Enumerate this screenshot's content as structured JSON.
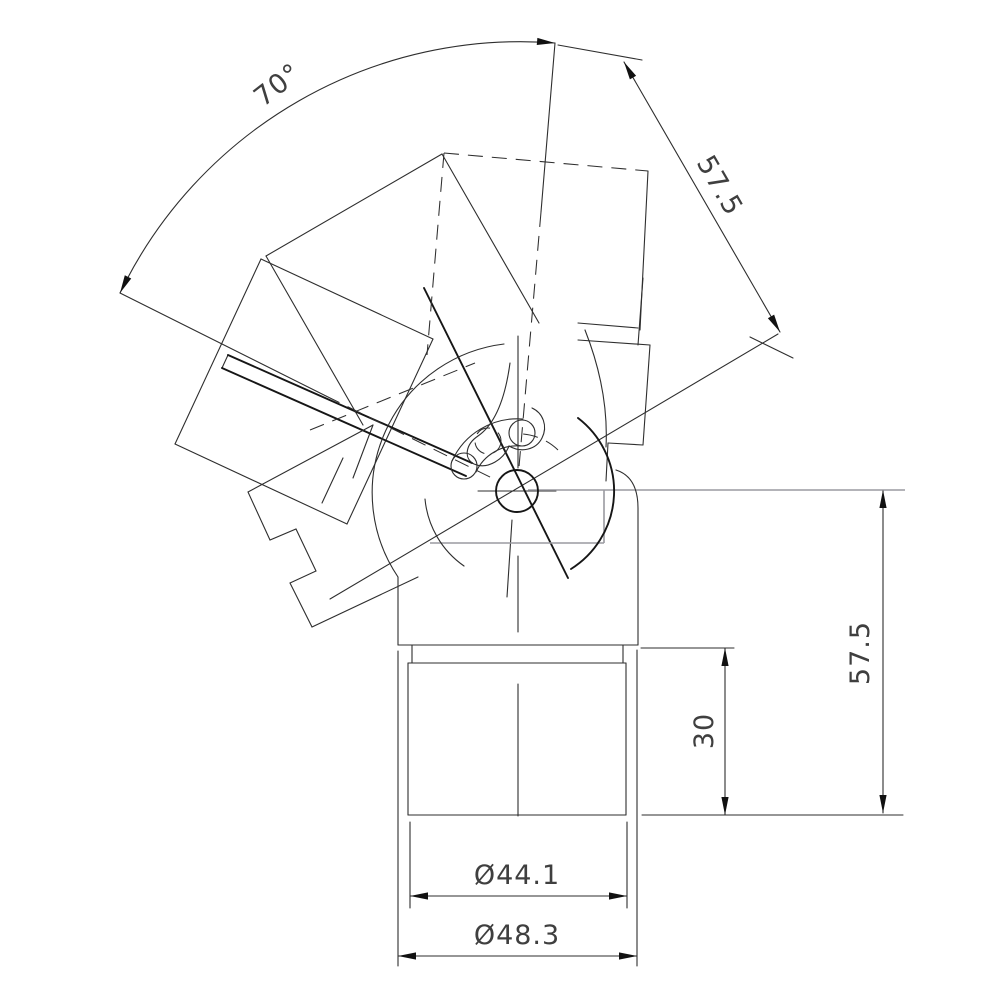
{
  "page": {
    "kind": "technical-cad-drawing",
    "description": "Orthographic drawing of an adjustable elbow tube connector with 70 degree swivel range"
  },
  "dimensions": {
    "swivel_angle": "70°",
    "arm_length": "57.5",
    "overall_height": "57.5",
    "insert_depth": "30",
    "inner_diameter": "Ø44.1",
    "outer_diameter": "Ø48.3"
  },
  "drawing": {
    "width": 1000,
    "height": 1000,
    "colors": {
      "main": "#2e2e2e",
      "dark": "#161616",
      "gray": "#9a9aa0",
      "text": "#3f3f3f"
    },
    "segments": {
      "solid": [
        [
          "housing-left",
          398,
          577,
          398,
          645
        ],
        [
          "housing-bottom",
          398,
          645,
          638,
          645
        ],
        [
          "housing-right",
          638,
          508,
          638,
          645
        ],
        [
          "neck-left",
          412,
          645,
          412,
          663
        ],
        [
          "neck-right",
          623,
          645,
          623,
          663
        ],
        [
          "lower-tube-top",
          408,
          663,
          626,
          663
        ],
        [
          "lower-tube-left",
          408,
          663,
          408,
          815
        ],
        [
          "lower-tube-right",
          626,
          663,
          626,
          815
        ],
        [
          "lower-tube-bottom",
          408,
          815,
          626,
          815
        ],
        [
          "centerline-upper",
          518,
          336,
          518,
          468
        ],
        [
          "centerline-mid",
          518,
          556,
          518,
          632
        ],
        [
          "centerline-lower",
          518,
          684,
          518,
          816
        ],
        [
          "pivot-crosshair",
          478,
          491,
          556,
          491
        ],
        [
          "ext-line-30-top",
          641,
          648,
          734,
          648
        ],
        [
          "ext-line-bottom",
          642,
          815,
          903,
          815
        ],
        [
          "dim-line-57-right",
          883,
          490,
          883,
          813
        ],
        [
          "dim-line-30",
          725,
          648,
          725,
          815
        ],
        [
          "dim-line-44",
          410,
          896,
          627,
          896
        ],
        [
          "dim-line-48",
          398,
          956,
          637,
          956
        ],
        [
          "ext-line-44-left",
          410,
          822,
          410,
          908
        ],
        [
          "ext-line-44-right",
          627,
          822,
          627,
          908
        ],
        [
          "ext-line-48-left",
          398,
          651,
          398,
          966
        ],
        [
          "ext-line-48-right",
          637,
          650,
          637,
          966
        ],
        [
          "dim-line-57-oblique",
          624,
          62,
          780,
          332
        ],
        [
          "ext-57-oblique-top",
          558,
          45,
          642,
          60
        ],
        [
          "ext-57-oblique-bottom",
          750,
          337,
          793,
          358
        ],
        [
          "angle-leg-85-upper",
          555,
          43,
          541,
          212
        ],
        [
          "angle-leg-85-lower",
          512,
          520,
          507,
          597
        ],
        [
          "angle-leg-155-upper",
          120,
          293,
          326,
          396
        ],
        [
          "pivot-ray-30deg",
          330,
          599,
          778,
          334
        ],
        [
          "tube-155-end",
          261,
          259,
          175,
          444
        ],
        [
          "tube-155-upper",
          261,
          259,
          433,
          339
        ],
        [
          "tube-155-lower",
          175,
          444,
          347,
          524
        ],
        [
          "tube-155-near",
          433,
          339,
          347,
          524
        ],
        [
          "tube-120-end",
          442,
          154,
          266,
          256
        ],
        [
          "tube-120-right",
          442,
          154,
          539,
          323
        ],
        [
          "tube-120-left",
          266,
          256,
          363,
          425
        ],
        [
          "tube-85-right",
          648,
          171,
          640,
          330
        ],
        [
          "socket-85-end-a",
          578,
          323,
          638,
          328
        ],
        [
          "socket-85-end-b",
          578,
          340,
          650,
          345
        ],
        [
          "clamp-85-step-a",
          643,
          278,
          638,
          345
        ],
        [
          "clamp-85-step-b",
          650,
          345,
          643,
          445
        ],
        [
          "clamp-85-step-c",
          643,
          445,
          608,
          443
        ],
        [
          "clamp-85-step-d",
          608,
          443,
          606,
          481
        ],
        [
          "clamp-155-far-a",
          322,
          503,
          343,
          458
        ],
        [
          "clamp-155-far-b",
          353,
          478,
          373,
          425
        ],
        [
          "lever-end-cap",
          228,
          355,
          222,
          368
        ]
      ],
      "dark": [
        [
          "lever-upper-edge",
          472,
          463,
          228,
          355
        ],
        [
          "lever-lower-edge",
          466,
          476,
          222,
          368
        ],
        [
          "centerline-116",
          424,
          288,
          568,
          578
        ]
      ],
      "dashed": [
        [
          "angle-leg-85-mid",
          541,
          212,
          519,
          467
        ],
        [
          "angle-leg-155-mid",
          326,
          396,
          498,
          481
        ],
        [
          "tube-85-top-phantom",
          444,
          153,
          648,
          171
        ],
        [
          "tube-85-left-phantom",
          444,
          153,
          427,
          355
        ],
        [
          "lever-phantom",
          310,
          430,
          475,
          363
        ]
      ],
      "gray": [
        [
          "ext-57-right-top",
          528,
          490,
          905,
          490
        ],
        [
          "ghost-edge-h",
          430,
          543,
          604,
          543
        ],
        [
          "ghost-edge-v",
          604,
          490,
          604,
          543
        ]
      ]
    },
    "paths": {
      "solid": [
        [
          "angle-arc-70",
          "M 555,43 A 445 445 0 0 0 120,293"
        ],
        [
          "ball-arc",
          "M 504,344 A 150 150 0 0 0 398,577"
        ],
        [
          "ball-arc-left",
          "M 425,499 A 92 92 0 0 0 464,566"
        ],
        [
          "socket-bell-curve",
          "M 585,330 C 600,368 608,408 606,447"
        ],
        [
          "slot-outer-arc",
          "M 523,419 A 72 72 0 0 0 452,461"
        ],
        [
          "slot-inner-arc",
          "M 521,446 A 45 45 0 0 0 476,472"
        ],
        [
          "housing-corner-round",
          "M 638,508 Q 638,477 616,470"
        ],
        [
          "clamp-155-steps",
          "M 373,425 L 248,492 L 270,540 L 296,529 L 316,571 L 290,583 L 312,627 L 418,577"
        ],
        [
          "clamp-hook",
          "M 510,363 C 505,400 494,425 478,436 C 466,444 463,458 474,464 C 488,470 504,459 509,446"
        ],
        [
          "clamp-hook-right",
          "M 509,446 C 521,453 536,450 542,438 C 548,426 543,413 532,408"
        ]
      ],
      "dark": [
        [
          "ball-arc-dark",
          "M 578,418 A 92 92 0 0 1 571,569"
        ]
      ],
      "dashed": [
        [
          "slot-ext-arc",
          "M 558,450 A 58 58 0 0 0 523,434"
        ]
      ]
    },
    "circles": {
      "dark": [
        [
          "pivot-circle",
          517,
          491,
          21
        ]
      ],
      "solid": [
        [
          "bolt-85",
          522,
          433,
          13
        ],
        [
          "bolt-155",
          464,
          466,
          13
        ]
      ],
      "dashed": [
        [
          "bolt-phantom",
          488,
          441,
          13
        ]
      ]
    },
    "arrows": [
      [
        "arrow-arc-top",
        555,
        43,
        5
      ],
      [
        "arrow-arc-bottom",
        120,
        293,
        116.5
      ],
      [
        "arrow-57o-top",
        624,
        62,
        -120
      ],
      [
        "arrow-57o-bottom",
        780,
        332,
        60
      ],
      [
        "arrow-57r-top",
        883,
        490,
        -90
      ],
      [
        "arrow-57r-bottom",
        883,
        813,
        90
      ],
      [
        "arrow-30-top",
        725,
        648,
        -90
      ],
      [
        "arrow-30-bottom",
        725,
        815,
        90
      ],
      [
        "arrow-44-left",
        410,
        896,
        180
      ],
      [
        "arrow-44-right",
        627,
        896,
        0
      ],
      [
        "arrow-48-left",
        398,
        956,
        180
      ],
      [
        "arrow-48-right",
        637,
        956,
        0
      ]
    ],
    "labels": [
      {
        "name": "dim-label-angle",
        "text": "70°",
        "x": 283,
        "y": 92,
        "rot": -38
      },
      {
        "name": "dim-label-arm-length",
        "text": "57.5",
        "x": 712,
        "y": 190,
        "rot": 60
      },
      {
        "name": "dim-label-height",
        "text": "57.5",
        "x": 869,
        "y": 653,
        "rot": -90
      },
      {
        "name": "dim-label-insert-depth",
        "text": "30",
        "x": 713,
        "y": 731,
        "rot": -90
      },
      {
        "name": "dim-label-inner-dia",
        "text": "Ø44.1",
        "x": 517,
        "y": 884,
        "rot": 0
      },
      {
        "name": "dim-label-outer-dia",
        "text": "Ø48.3",
        "x": 517,
        "y": 944,
        "rot": 0
      }
    ]
  }
}
